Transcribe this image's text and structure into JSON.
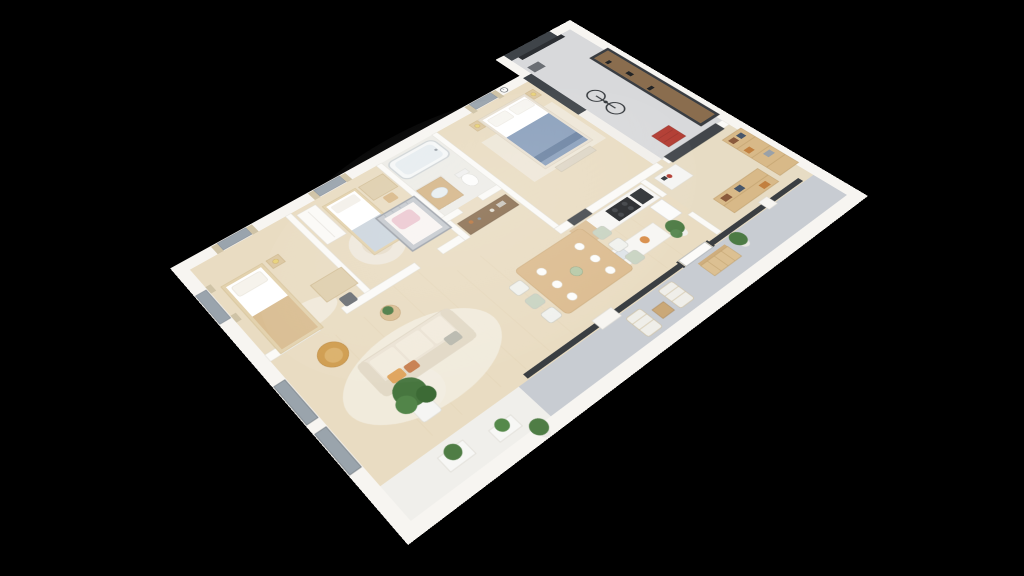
{
  "meta": {
    "label": "3D isometric floor plan rendering of a furnished apartment on a black background",
    "view": "axonometric 3D cutaway, no visible text"
  },
  "palette": {
    "background": "#000000",
    "wall_white": "#f7f5f1",
    "wall_shade": "#dcd9d3",
    "wood_floor": "#e9dcc2",
    "terrace_gray": "#c8ccd2",
    "glass_dark": "#3a3e42",
    "garage_dark": "#3f4449",
    "furniture_wood": "#dcbc90",
    "dark_wood": "#8a6e50",
    "sofa_cream": "#ebe3d4",
    "mustard": "#cf9c4e",
    "terracotta": "#c77f4f",
    "bed_blue": "#8ba0bc",
    "blanket_tan": "#d9bd92",
    "crib_pink": "#ecc9d2",
    "plant_green": "#4c7a44",
    "bench_dark": "#33373c",
    "toolbox_red": "#b13a30"
  },
  "scene": {
    "rooms": [
      {
        "name": "bedroom-1",
        "items": [
          "single-bed",
          "tan-blanket",
          "nightstand-lamp",
          "desk",
          "chair",
          "rug",
          "window-curtains"
        ]
      },
      {
        "name": "nursery",
        "items": [
          "single-bed",
          "wardrobe",
          "crib-pink-bedding",
          "round-rug",
          "desk",
          "window-curtains"
        ]
      },
      {
        "name": "bathroom",
        "items": [
          "bathtub",
          "wood-vanity-sink",
          "toilet"
        ]
      },
      {
        "name": "master-bedroom",
        "items": [
          "double-bed-blue-duvet",
          "two-nightstands",
          "foot-bench",
          "rug",
          "wall-clock",
          "window-curtains",
          "dark-door"
        ]
      },
      {
        "name": "garage-workshop",
        "items": [
          "dark-garage-door",
          "workbench",
          "pegboard",
          "bicycle",
          "red-tool-cabinet"
        ]
      },
      {
        "name": "kitchen",
        "items": [
          "counter",
          "cooktop",
          "oven-appliance",
          "fridge",
          "island-sink",
          "sideboard-with-jars"
        ]
      },
      {
        "name": "dining-area",
        "items": [
          "wood-table",
          "six-chairs",
          "place-settings"
        ]
      },
      {
        "name": "living-room",
        "items": [
          "cream-sofa",
          "throw-pillows",
          "mustard-armchair",
          "side-table-plant",
          "fiddle-leaf-plant",
          "area-rug"
        ]
      },
      {
        "name": "storage-office",
        "items": [
          "wood-shelving-baskets",
          "small-desk",
          "potted-plant"
        ]
      },
      {
        "name": "terrace",
        "items": [
          "two-deck-chairs",
          "coffee-table",
          "entry-bench",
          "potted-plants",
          "sliding-glass-doors"
        ]
      },
      {
        "name": "front-planters",
        "items": [
          "white-planter-boxes",
          "green-plants"
        ]
      }
    ]
  }
}
